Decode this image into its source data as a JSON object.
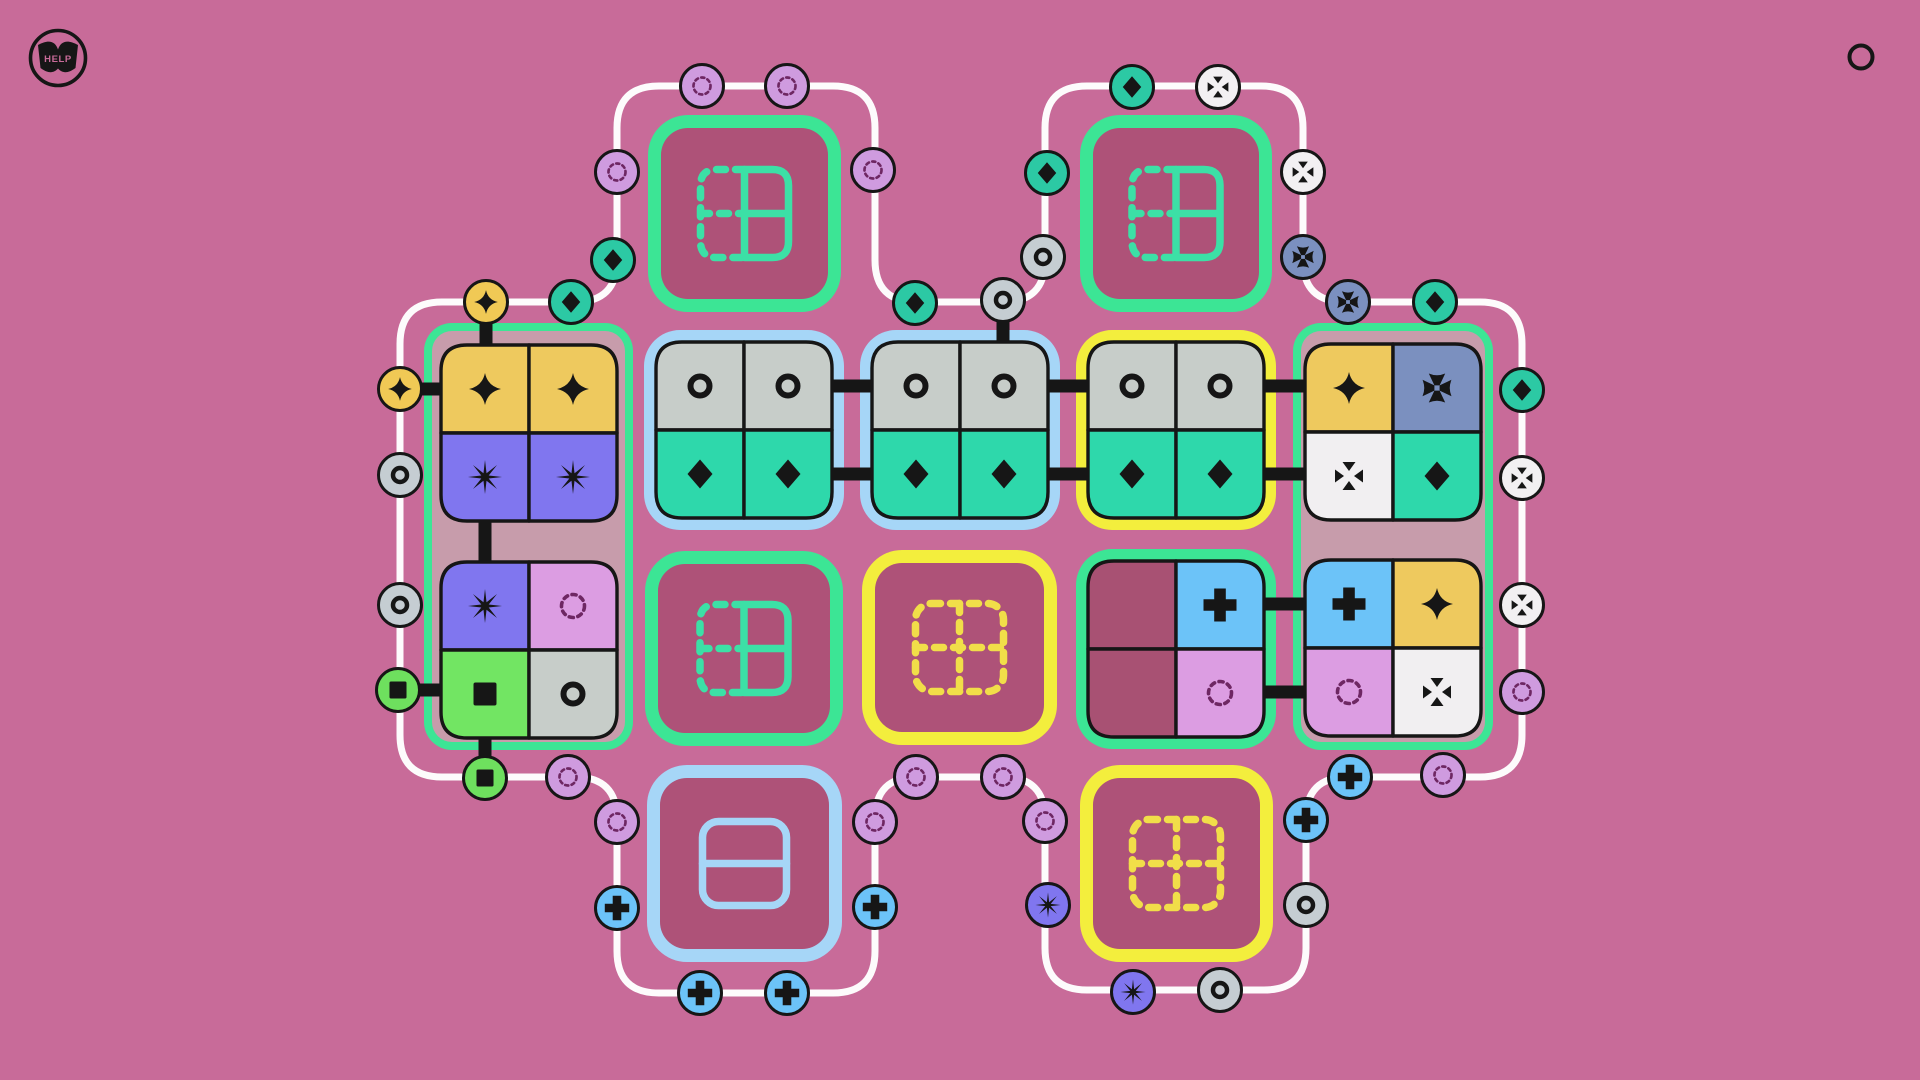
{
  "help": {
    "label": "HELP"
  },
  "corner_button": {
    "shape": "ring"
  },
  "palette": {
    "background": "#c86b99",
    "mauve": "#c79cab",
    "maroon_fill": "#ae5278",
    "track": "#fdfbfc",
    "line_black": "#161616",
    "border_green": "#3ce595",
    "border_blue": "#a6d6f7",
    "border_yellow": "#f3ee3d",
    "icon_teal": "#3ce0a6",
    "icon_yellow": "#f1de49",
    "icon_blue": "#a6d6f7",
    "glyph_black": "#161616",
    "glyph_plum": "#6e2763",
    "cell_yellow": "#eec95e",
    "cell_periwinkle": "#8076ef",
    "cell_gray": "#c7cdc9",
    "cell_teal": "#2ed8ab",
    "cell_ltblue": "#6cc3f8",
    "cell_slate": "#7b90bf",
    "cell_orchid": "#dc9de2",
    "cell_white": "#f1eff1",
    "cell_green": "#72e563",
    "cell_maroon": "#a85173",
    "badge_star": "#f0c955",
    "badge_ring": "#c5cdd2",
    "badge_square": "#6ee05e",
    "badge_dashed": "#cf9bdf",
    "badge_plus": "#6cc3f8",
    "badge_burst": "#8076ef",
    "badge_diamond": "#2cc9a4",
    "badge_cross": "#7b90bf",
    "badge_tri": "#f2f0f2"
  },
  "board": {
    "track": {
      "radius": 42,
      "width": 7,
      "vertices": [
        [
          400,
          302
        ],
        [
          400,
          777
        ],
        [
          617,
          777
        ],
        [
          617,
          993
        ],
        [
          875,
          993
        ],
        [
          875,
          777
        ],
        [
          1045,
          777
        ],
        [
          1045,
          990
        ],
        [
          1306,
          990
        ],
        [
          1306,
          777
        ],
        [
          1522,
          777
        ],
        [
          1522,
          302
        ],
        [
          1303,
          302
        ],
        [
          1303,
          86
        ],
        [
          1045,
          86
        ],
        [
          1045,
          302
        ],
        [
          875,
          302
        ],
        [
          875,
          86
        ],
        [
          617,
          86
        ],
        [
          617,
          302
        ]
      ]
    },
    "containers": [
      {
        "name": "target-block-top-left",
        "x": 648,
        "y": 115,
        "w": 193,
        "h": 197,
        "r": 40,
        "bw": 13,
        "border": "border_green",
        "fill": "maroon_fill",
        "icon": "half-grid",
        "iconColor": "icon_teal"
      },
      {
        "name": "target-block-top-right",
        "x": 1080,
        "y": 115,
        "w": 192,
        "h": 197,
        "r": 40,
        "bw": 13,
        "border": "border_green",
        "fill": "maroon_fill",
        "icon": "half-grid",
        "iconColor": "icon_teal"
      },
      {
        "name": "piece-frame-left",
        "x": 424,
        "y": 323,
        "w": 209,
        "h": 427,
        "r": 28,
        "bw": 8,
        "border": "border_green",
        "fill": "mauve"
      },
      {
        "name": "piece-frame-right",
        "x": 1293,
        "y": 323,
        "w": 200,
        "h": 427,
        "r": 28,
        "bw": 8,
        "border": "border_green",
        "fill": "mauve"
      },
      {
        "name": "piece-frame-blue-1",
        "x": 644,
        "y": 330,
        "w": 200,
        "h": 200,
        "r": 36,
        "bw": 12,
        "border": "border_blue",
        "fill": "border_blue"
      },
      {
        "name": "piece-frame-blue-2",
        "x": 860,
        "y": 330,
        "w": 200,
        "h": 200,
        "r": 36,
        "bw": 12,
        "border": "border_blue",
        "fill": "border_blue"
      },
      {
        "name": "piece-frame-yellow",
        "x": 1076,
        "y": 330,
        "w": 200,
        "h": 200,
        "r": 36,
        "bw": 12,
        "border": "border_yellow",
        "fill": "border_yellow"
      },
      {
        "name": "piece-frame-green-small",
        "x": 1076,
        "y": 549,
        "w": 200,
        "h": 200,
        "r": 36,
        "bw": 11,
        "border": "border_green",
        "fill": "mauve"
      },
      {
        "name": "target-block-mid-left",
        "x": 645,
        "y": 551,
        "w": 198,
        "h": 195,
        "r": 40,
        "bw": 13,
        "border": "border_green",
        "fill": "maroon_fill",
        "icon": "half-grid",
        "iconColor": "icon_teal"
      },
      {
        "name": "target-block-mid-right",
        "x": 862,
        "y": 550,
        "w": 195,
        "h": 195,
        "r": 40,
        "bw": 13,
        "border": "border_yellow",
        "fill": "maroon_fill",
        "icon": "dash-grid",
        "iconColor": "icon_yellow"
      },
      {
        "name": "target-block-bottom-left",
        "x": 647,
        "y": 765,
        "w": 195,
        "h": 197,
        "r": 40,
        "bw": 13,
        "border": "border_blue",
        "fill": "maroon_fill",
        "icon": "split-h",
        "iconColor": "icon_blue"
      },
      {
        "name": "target-block-bottom-right",
        "x": 1080,
        "y": 765,
        "w": 193,
        "h": 197,
        "r": 40,
        "bw": 13,
        "border": "border_yellow",
        "fill": "maroon_fill",
        "icon": "dash-grid",
        "iconColor": "icon_yellow"
      }
    ],
    "connectors": [
      [
        830,
        386,
        874,
        386
      ],
      [
        830,
        474,
        874,
        474
      ],
      [
        1046,
        386,
        1090,
        386
      ],
      [
        1046,
        474,
        1090,
        474
      ],
      [
        1262,
        386,
        1307,
        386
      ],
      [
        1262,
        474,
        1307,
        474
      ],
      [
        1262,
        604,
        1307,
        604
      ],
      [
        1262,
        692,
        1307,
        692
      ],
      [
        485,
        516,
        485,
        564
      ],
      [
        486,
        302,
        486,
        347
      ],
      [
        400,
        389,
        447,
        389
      ],
      [
        398,
        690,
        447,
        690
      ],
      [
        485,
        737,
        485,
        778
      ],
      [
        1003,
        300,
        1003,
        344
      ]
    ],
    "pieces": [
      {
        "name": "piece-star-burst",
        "x": 441,
        "y": 345,
        "cells": [
          [
            "cell_yellow",
            "star"
          ],
          [
            "cell_yellow",
            "star"
          ],
          [
            "cell_periwinkle",
            "burst"
          ],
          [
            "cell_periwinkle",
            "burst"
          ]
        ]
      },
      {
        "name": "piece-mixed-left",
        "x": 441,
        "y": 562,
        "cells": [
          [
            "cell_periwinkle",
            "burst"
          ],
          [
            "cell_orchid",
            "dashed"
          ],
          [
            "cell_green",
            "square"
          ],
          [
            "cell_gray",
            "ring"
          ]
        ]
      },
      {
        "name": "piece-ring-diamond-1",
        "x": 656,
        "y": 342,
        "cells": [
          [
            "cell_gray",
            "ring"
          ],
          [
            "cell_gray",
            "ring"
          ],
          [
            "cell_teal",
            "diamond"
          ],
          [
            "cell_teal",
            "diamond"
          ]
        ]
      },
      {
        "name": "piece-ring-diamond-2",
        "x": 872,
        "y": 342,
        "cells": [
          [
            "cell_gray",
            "ring"
          ],
          [
            "cell_gray",
            "ring"
          ],
          [
            "cell_teal",
            "diamond"
          ],
          [
            "cell_teal",
            "diamond"
          ]
        ]
      },
      {
        "name": "piece-ring-diamond-3",
        "x": 1088,
        "y": 342,
        "cells": [
          [
            "cell_gray",
            "ring"
          ],
          [
            "cell_gray",
            "ring"
          ],
          [
            "cell_teal",
            "diamond"
          ],
          [
            "cell_teal",
            "diamond"
          ]
        ]
      },
      {
        "name": "piece-mixed-right-top",
        "x": 1305,
        "y": 344,
        "cells": [
          [
            "cell_yellow",
            "star"
          ],
          [
            "cell_slate",
            "cross"
          ],
          [
            "cell_white",
            "tri"
          ],
          [
            "cell_teal",
            "diamond"
          ]
        ]
      },
      {
        "name": "piece-mixed-right-bottom",
        "x": 1305,
        "y": 560,
        "cells": [
          [
            "cell_ltblue",
            "plus"
          ],
          [
            "cell_yellow",
            "star"
          ],
          [
            "cell_orchid",
            "dashed"
          ],
          [
            "cell_white",
            "tri"
          ]
        ]
      },
      {
        "name": "piece-half-empty",
        "x": 1088,
        "y": 561,
        "cells": [
          [
            "cell_maroon",
            null
          ],
          [
            "cell_ltblue",
            "plus"
          ],
          [
            "cell_maroon",
            null
          ],
          [
            "cell_orchid",
            "dashed"
          ]
        ]
      }
    ],
    "badges": [
      {
        "x": 400,
        "y": 389,
        "sym": "star"
      },
      {
        "x": 400,
        "y": 475,
        "sym": "ring"
      },
      {
        "x": 400,
        "y": 605,
        "sym": "ring"
      },
      {
        "x": 398,
        "y": 690,
        "sym": "square"
      },
      {
        "x": 485,
        "y": 778,
        "sym": "square"
      },
      {
        "x": 568,
        "y": 777,
        "sym": "dashed"
      },
      {
        "x": 617,
        "y": 822,
        "sym": "dashed"
      },
      {
        "x": 617,
        "y": 908,
        "sym": "plus"
      },
      {
        "x": 700,
        "y": 993,
        "sym": "plus"
      },
      {
        "x": 787,
        "y": 993,
        "sym": "plus"
      },
      {
        "x": 875,
        "y": 907,
        "sym": "plus"
      },
      {
        "x": 875,
        "y": 822,
        "sym": "dashed"
      },
      {
        "x": 916,
        "y": 777,
        "sym": "dashed"
      },
      {
        "x": 1003,
        "y": 777,
        "sym": "dashed"
      },
      {
        "x": 1045,
        "y": 821,
        "sym": "dashed"
      },
      {
        "x": 1048,
        "y": 905,
        "sym": "burst"
      },
      {
        "x": 1133,
        "y": 992,
        "sym": "burst"
      },
      {
        "x": 1220,
        "y": 990,
        "sym": "ring"
      },
      {
        "x": 1306,
        "y": 905,
        "sym": "ring"
      },
      {
        "x": 1306,
        "y": 820,
        "sym": "plus"
      },
      {
        "x": 1350,
        "y": 777,
        "sym": "plus"
      },
      {
        "x": 1443,
        "y": 775,
        "sym": "dashed"
      },
      {
        "x": 1522,
        "y": 692,
        "sym": "dashed"
      },
      {
        "x": 1522,
        "y": 605,
        "sym": "tri"
      },
      {
        "x": 1522,
        "y": 478,
        "sym": "tri"
      },
      {
        "x": 1522,
        "y": 390,
        "sym": "diamond"
      },
      {
        "x": 1435,
        "y": 302,
        "sym": "diamond"
      },
      {
        "x": 1348,
        "y": 302,
        "sym": "cross"
      },
      {
        "x": 1303,
        "y": 257,
        "sym": "cross"
      },
      {
        "x": 1303,
        "y": 172,
        "sym": "tri"
      },
      {
        "x": 1218,
        "y": 87,
        "sym": "tri"
      },
      {
        "x": 1132,
        "y": 87,
        "sym": "diamond"
      },
      {
        "x": 1047,
        "y": 173,
        "sym": "diamond"
      },
      {
        "x": 1043,
        "y": 257,
        "sym": "ring"
      },
      {
        "x": 1003,
        "y": 300,
        "sym": "ring"
      },
      {
        "x": 915,
        "y": 303,
        "sym": "diamond"
      },
      {
        "x": 873,
        "y": 170,
        "sym": "dashed"
      },
      {
        "x": 787,
        "y": 86,
        "sym": "dashed"
      },
      {
        "x": 702,
        "y": 86,
        "sym": "dashed"
      },
      {
        "x": 617,
        "y": 172,
        "sym": "dashed"
      },
      {
        "x": 613,
        "y": 260,
        "sym": "diamond"
      },
      {
        "x": 571,
        "y": 302,
        "sym": "diamond"
      },
      {
        "x": 486,
        "y": 302,
        "sym": "star"
      }
    ]
  }
}
